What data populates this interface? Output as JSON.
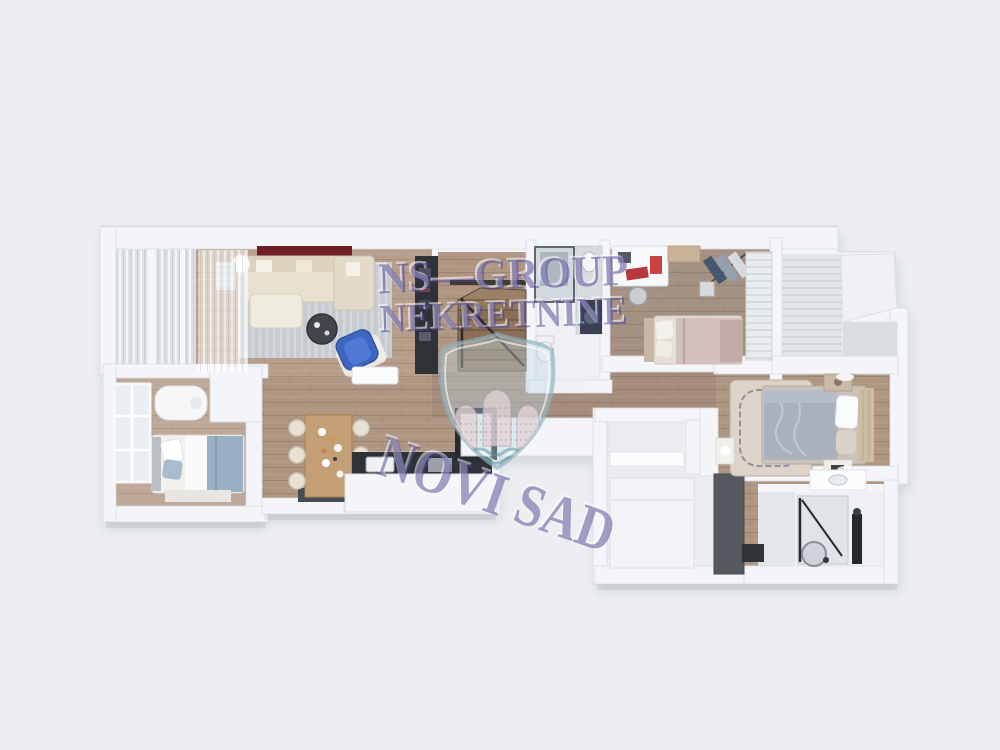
{
  "watermark": {
    "line1": "NS—GROUP",
    "line2": "NEKRETNINE",
    "line3": "NOVI SAD",
    "text_color": "#4b4391",
    "emboss_color": "#ffffff",
    "shield": {
      "body_color": "#bcd6e0",
      "border_color": "#8fb0bd",
      "tower_color": "#e1d2d4",
      "wave_color": "#5a96a5"
    }
  },
  "scene": {
    "type": "3d-floor-plan-top-view-render",
    "colors": {
      "background": "#eceef1",
      "wall": "#f4f5f8",
      "wall_edge": "#d9dce2",
      "wall_recess": "#d9dce1",
      "wood": "#af9683",
      "wood_light": "#c3ab96",
      "wood_gray": "#9b8a7c",
      "tile": "#eef0f3",
      "terrace_floor": "#e1e4e9",
      "rug_gray": "#c8cdd2",
      "sofa_beige": "#e7dfd0",
      "accent_red": "#6e1d22",
      "accent_blue": "#3d66c0",
      "dark_cabinet": "#2e3237",
      "charcoal_wardrobe": "#55595f",
      "bed_blue": "#9aaec4",
      "bed_pink": "#d3bfbe",
      "master_duvet": "#aab1bc"
    }
  }
}
